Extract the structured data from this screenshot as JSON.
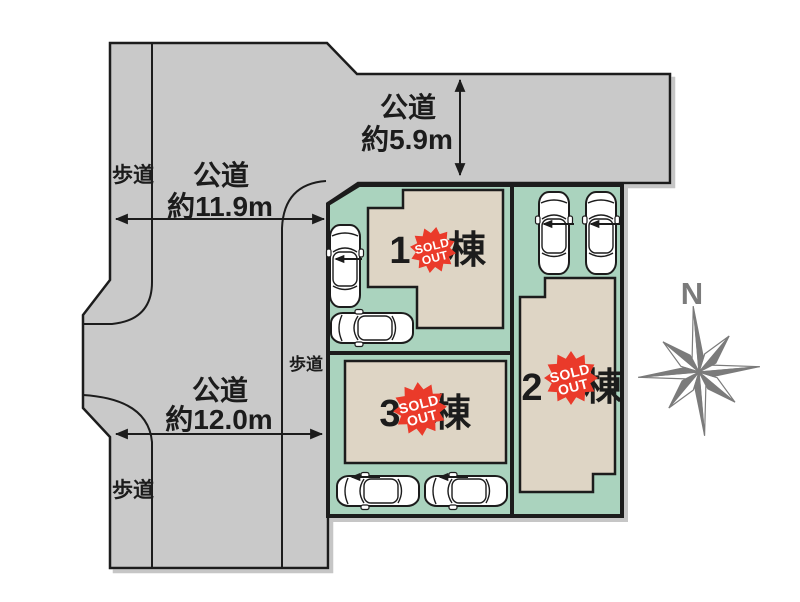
{
  "plan": {
    "roads": {
      "top": {
        "label": "公道",
        "width": "約5.9m"
      },
      "west_upper": {
        "label": "公道",
        "width": "約11.9m"
      },
      "west_lower": {
        "label": "公道",
        "width": "約12.0m"
      }
    },
    "sidewalks": [
      {
        "label": "歩道"
      },
      {
        "label": "歩道"
      },
      {
        "label": "歩道"
      }
    ],
    "buildings": [
      {
        "number": "1",
        "unit": "棟",
        "badge": {
          "line1": "SOLD",
          "line2": "OUT"
        }
      },
      {
        "number": "2",
        "unit": "棟",
        "badge": {
          "line1": "SOLD",
          "line2": "OUT"
        }
      },
      {
        "number": "3",
        "unit": "棟",
        "badge": {
          "line1": "SOLD",
          "line2": "OUT"
        }
      }
    ],
    "compass": {
      "label": "N"
    },
    "colors": {
      "road": "#c9c9c9",
      "plot_green": "#aad3be",
      "building": "#ded5c5",
      "badge_red": "#ea3a2a",
      "compass_gray": "#7b7b7b",
      "line": "#1c1c1c"
    }
  }
}
